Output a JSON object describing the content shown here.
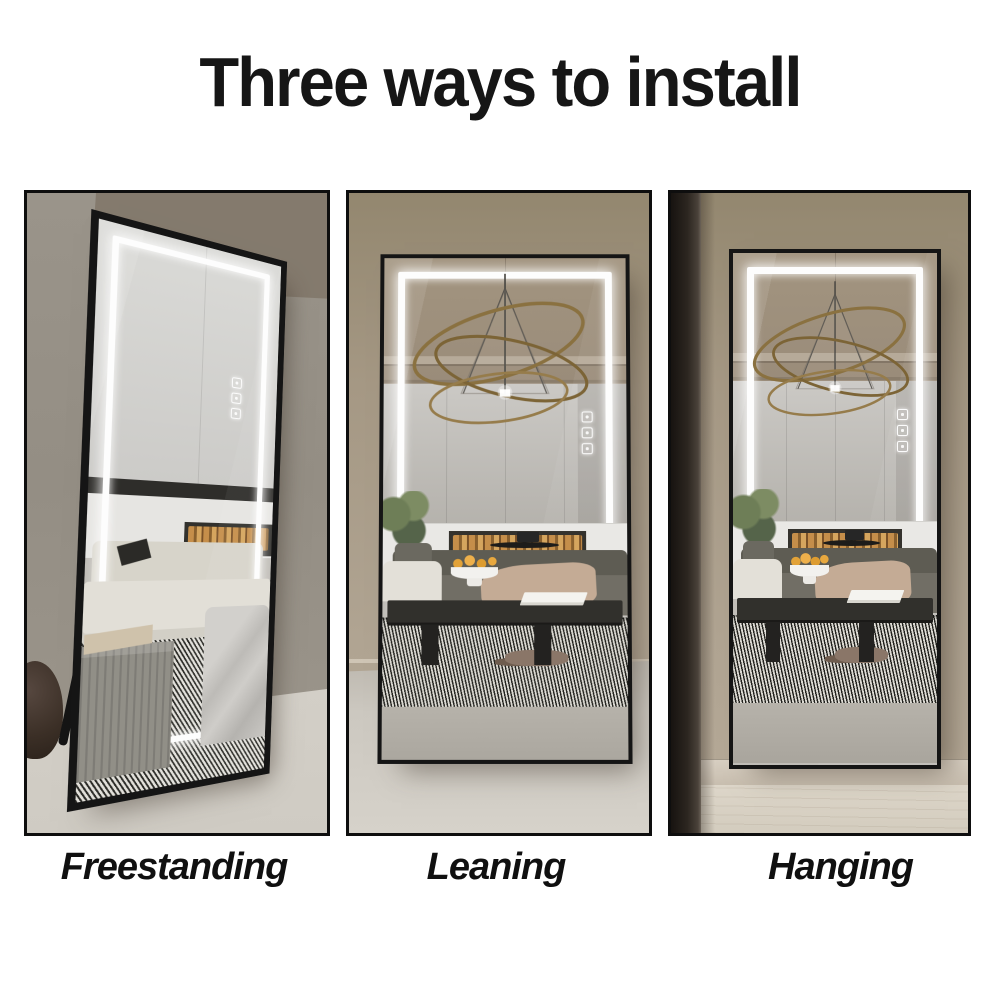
{
  "title": "Three ways to install",
  "methods": [
    {
      "id": "freestanding",
      "label": "Freestanding"
    },
    {
      "id": "leaning",
      "label": "Leaning"
    },
    {
      "id": "hanging",
      "label": "Hanging"
    }
  ],
  "product": {
    "name": "LED full-length mirror",
    "frame_color": "#151515",
    "led_color": "#ffffff",
    "touch_buttons": [
      "power-icon",
      "brightness-icon",
      "color-temperature-icon"
    ]
  },
  "colors": {
    "background": "#ffffff",
    "title_text": "#161616",
    "label_text": "#101010",
    "wall_taupe": "#a59884",
    "panel_border": "#0e0e0e"
  }
}
